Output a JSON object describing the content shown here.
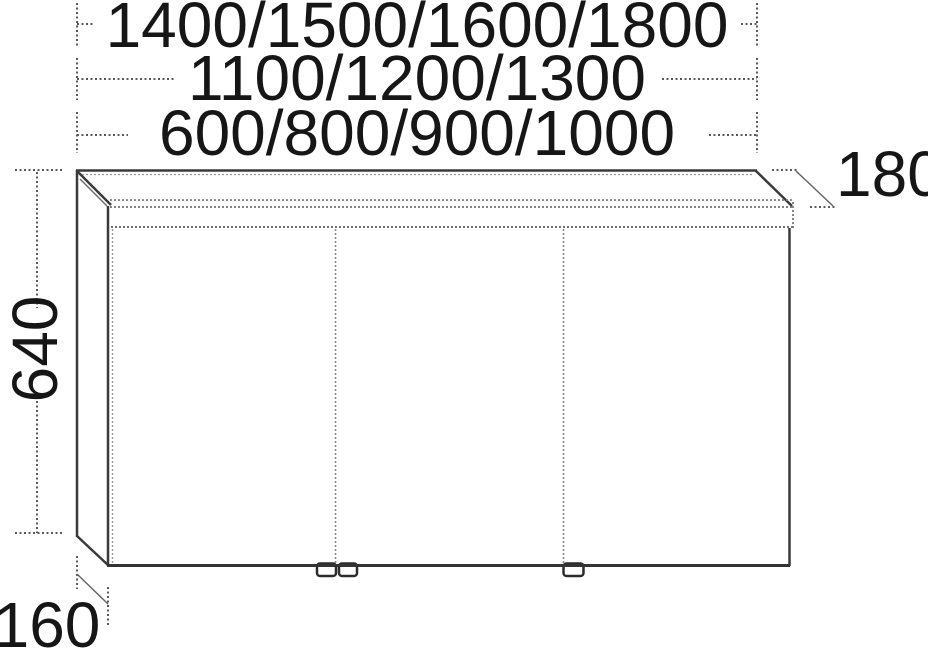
{
  "drawing": {
    "type": "furniture-dimension-diagram",
    "subject": "mirror-cabinet-three-doors-with-light-canopy",
    "colors": {
      "background": "#ffffff",
      "solid_line": "#333333",
      "stipple_line": "#7a7a7a",
      "guide_line": "#5a5a5a",
      "text": "#161616"
    }
  },
  "dimensions": {
    "width_options_row1": "1400/1500/1600/1800",
    "width_options_row2": "1100/1200/1300",
    "width_options_row3": "600/800/900/1000",
    "canopy_depth": "180",
    "cabinet_height": "640",
    "body_depth": "160"
  }
}
